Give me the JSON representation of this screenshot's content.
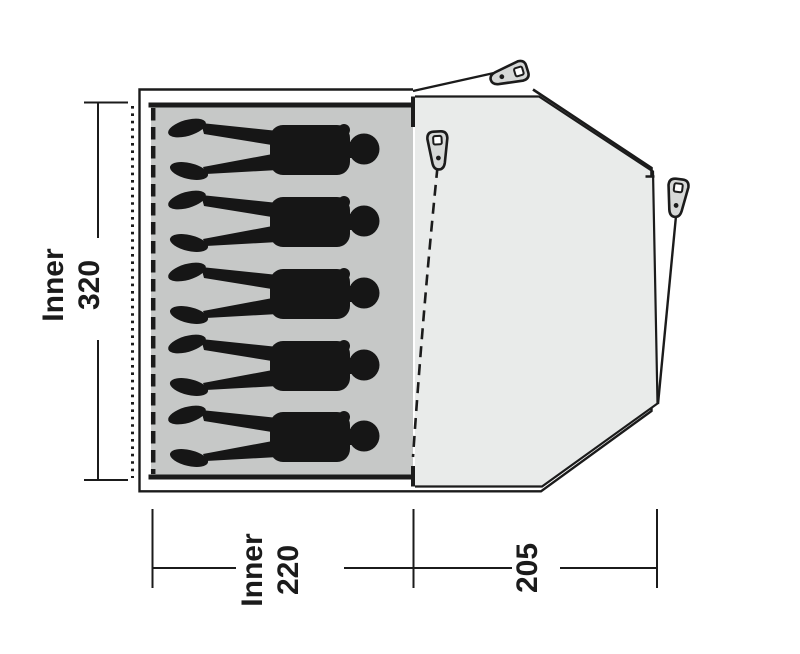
{
  "title": "Tent floor plan diagram",
  "colors": {
    "page_bg": "#ffffff",
    "line": "#1b1b1b",
    "inner_floor_fill": "#c6c8c7",
    "porch_fill": "#e9ebea",
    "peg_fill": "#d6d8d7",
    "silhouette_fill": "#161616"
  },
  "dimensions": {
    "inner_depth": {
      "line1": "Inner",
      "line2": "320"
    },
    "inner_width": {
      "line1": "Inner",
      "line2": "220"
    },
    "porch_depth": "205"
  },
  "occupants": {
    "person_count": 5
  },
  "icons": {
    "peg": "peg-icon",
    "person": "person-silhouette-icon"
  }
}
